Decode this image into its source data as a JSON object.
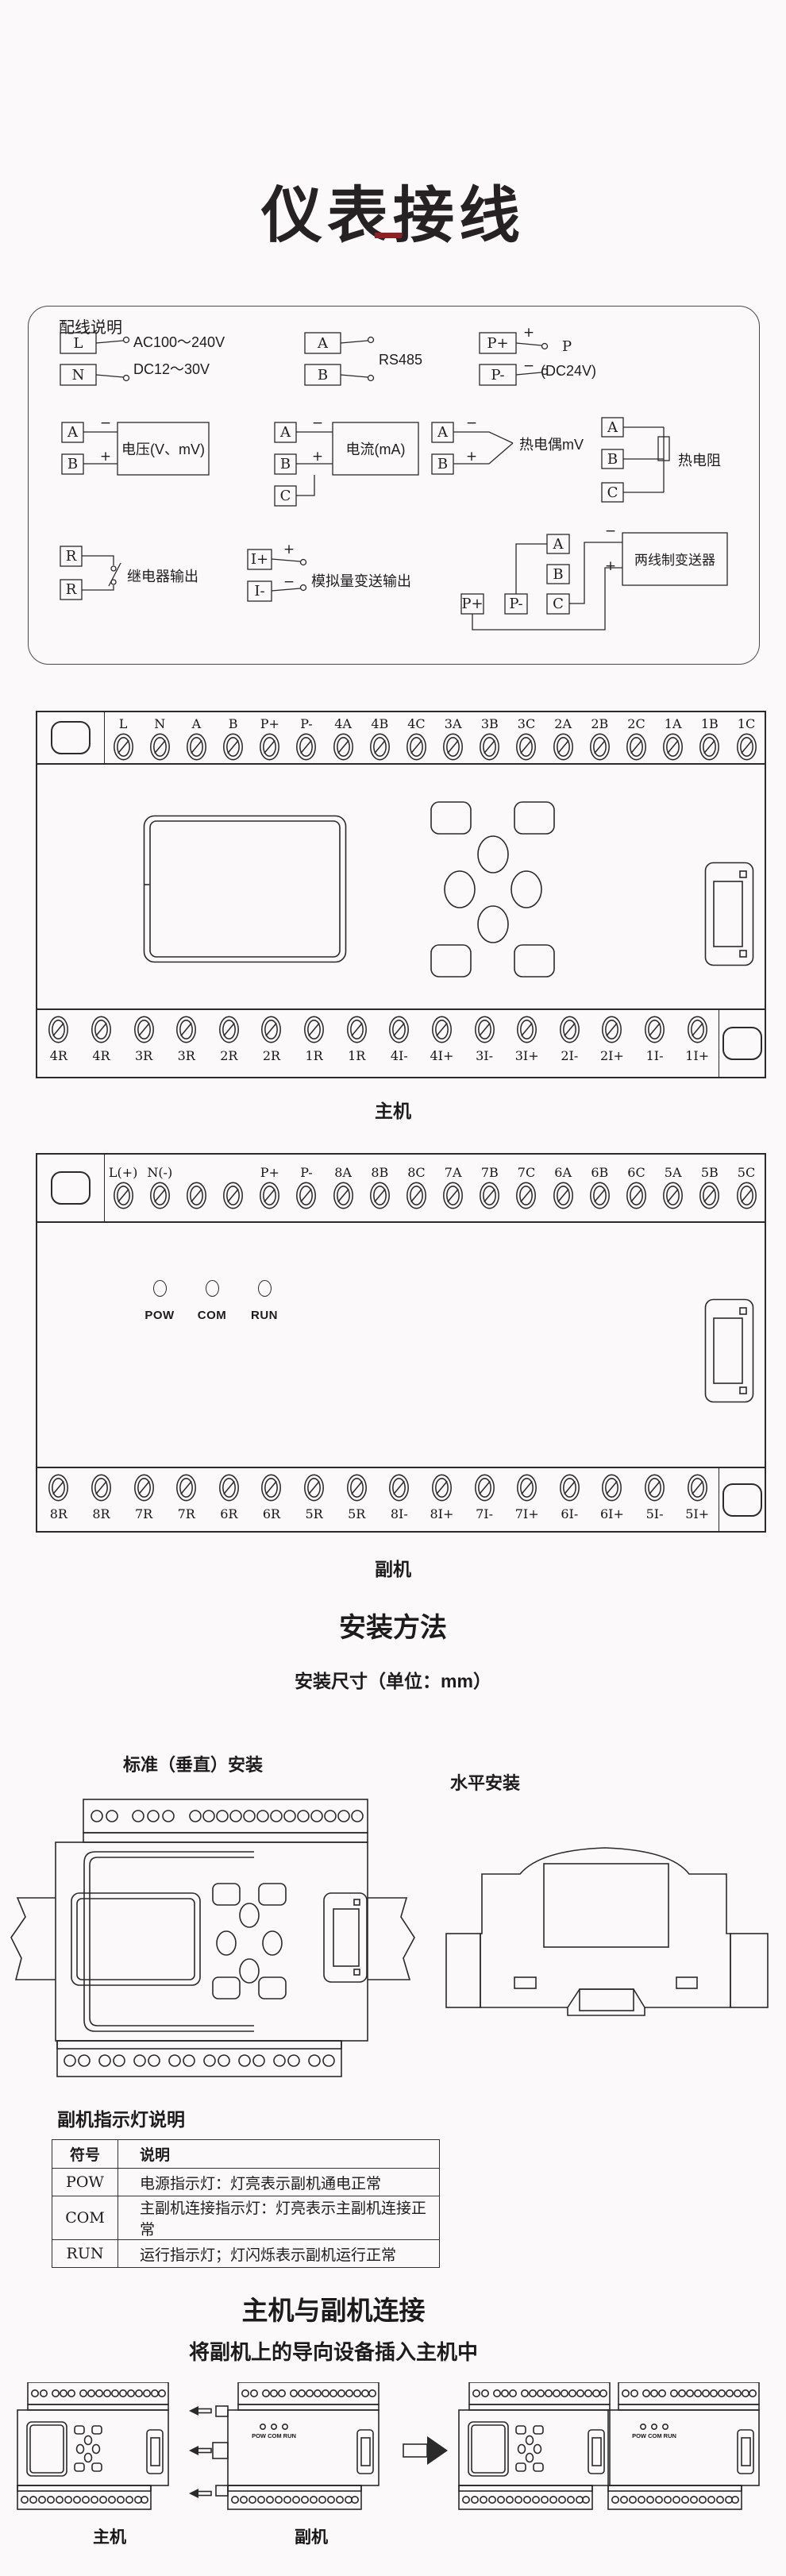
{
  "header": {
    "title": "仪表接线"
  },
  "wiring": {
    "title": "配线说明",
    "power_in": {
      "t1": "L",
      "t2": "N",
      "line1": "AC100～240V",
      "line2": "DC12～30V"
    },
    "rs485": {
      "t1": "A",
      "t2": "B",
      "label": "RS485"
    },
    "power_out": {
      "t1": "P+",
      "t2": "P-",
      "plus": "+",
      "minus": "−",
      "label1": "P",
      "label2": "(DC24V)"
    },
    "voltage": {
      "t1": "A",
      "t2": "B",
      "minus": "−",
      "plus": "+",
      "label": "电压(V、mV)"
    },
    "current": {
      "t1": "A",
      "t2": "B",
      "t3": "C",
      "minus": "−",
      "plus": "+",
      "label": "电流(mA)"
    },
    "thermocouple": {
      "t1": "A",
      "t2": "B",
      "minus": "−",
      "plus": "+",
      "label": "热电偶mV"
    },
    "rtd": {
      "t1": "A",
      "t2": "B",
      "t3": "C",
      "label": "热电阻"
    },
    "relay": {
      "t1": "R",
      "t2": "R",
      "label": "继电器输出"
    },
    "analog_out": {
      "t1": "I+",
      "t2": "I-",
      "plus": "+",
      "minus": "−",
      "label": "模拟量变送输出"
    },
    "two_wire": {
      "p1": "P+",
      "p2": "P-",
      "t1": "A",
      "t2": "B",
      "t3": "C",
      "minus": "−",
      "plus": "+",
      "label": "两线制变送器"
    }
  },
  "main_unit": {
    "caption": "主机",
    "top_terminals": [
      "L",
      "N",
      "A",
      "B",
      "P+",
      "P-",
      "4A",
      "4B",
      "4C",
      "3A",
      "3B",
      "3C",
      "2A",
      "2B",
      "2C",
      "1A",
      "1B",
      "1C"
    ],
    "bottom_terminals": [
      "4R",
      "4R",
      "3R",
      "3R",
      "2R",
      "2R",
      "1R",
      "1R",
      "4I-",
      "4I+",
      "3I-",
      "3I+",
      "2I-",
      "2I+",
      "1I-",
      "1I+"
    ]
  },
  "sub_unit": {
    "caption": "副机",
    "top_terminals": [
      "L(+)",
      "N(-)",
      "",
      "",
      "P+",
      "P-",
      "8A",
      "8B",
      "8C",
      "7A",
      "7B",
      "7C",
      "6A",
      "6B",
      "6C",
      "5A",
      "5B",
      "5C"
    ],
    "bottom_terminals": [
      "8R",
      "8R",
      "7R",
      "7R",
      "6R",
      "6R",
      "5R",
      "5R",
      "8I-",
      "8I+",
      "7I-",
      "7I+",
      "6I-",
      "6I+",
      "5I-",
      "5I+"
    ],
    "leds": [
      "POW",
      "COM",
      "RUN"
    ]
  },
  "install": {
    "heading": "安装方法",
    "subheading": "安装尺寸（单位：mm）",
    "vertical_label": "标准（垂直）安装",
    "horizontal_label": "水平安装"
  },
  "led_table": {
    "heading": "副机指示灯说明",
    "columns": [
      "符号",
      "说明"
    ],
    "rows": [
      {
        "symbol": "POW",
        "desc": "电源指示灯：灯亮表示副机通电正常"
      },
      {
        "symbol": "COM",
        "desc": "主副机连接指示灯：灯亮表示主副机连接正常"
      },
      {
        "symbol": "RUN",
        "desc": "运行指示灯；灯闪烁表示副机运行正常"
      }
    ]
  },
  "connection": {
    "heading": "主机与副机连接",
    "subheading": "将副机上的导向设备插入主机中",
    "main_label": "主机",
    "sub_label": "副机",
    "led_text": "POW COM RUN"
  }
}
